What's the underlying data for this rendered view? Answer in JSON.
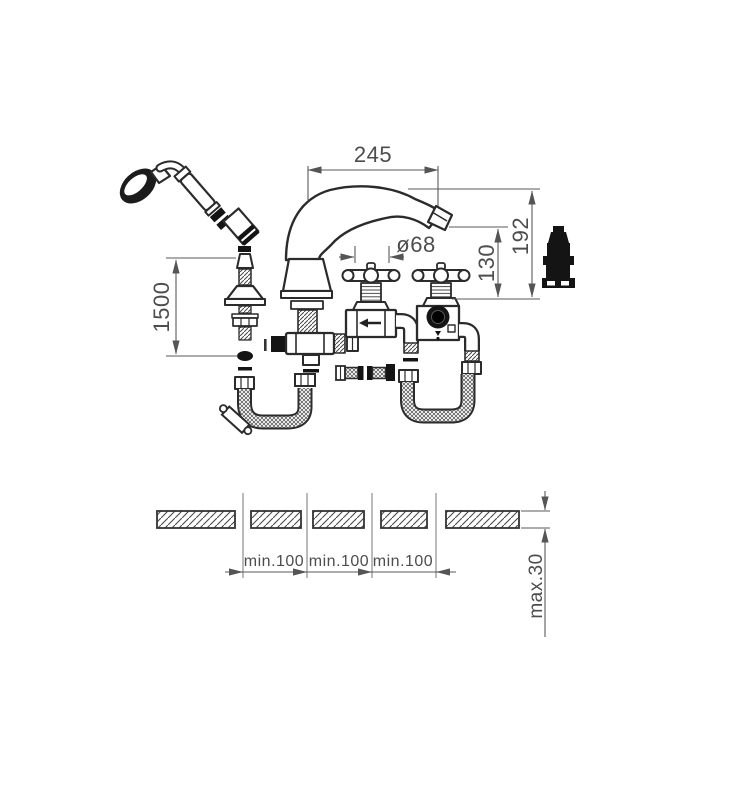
{
  "diagram": {
    "type": "technical-installation-drawing",
    "subject": "deck-mounted-bath-mixer-with-hand-shower",
    "colors": {
      "background": "#ffffff",
      "part_line": "#333333",
      "dimension_line": "#5a5a5a",
      "text": "#4d4d4d",
      "dark_fill": "#141414"
    },
    "dimensions": {
      "spout_reach": "245",
      "total_height": "192",
      "outlet_height": "130",
      "handle_diameter": "ø68",
      "shower_hose_length": "1500",
      "hole_pitch_a": "min.100",
      "hole_pitch_b": "min.100",
      "hole_pitch_c": "min.100",
      "deck_thickness": "max.30"
    }
  }
}
